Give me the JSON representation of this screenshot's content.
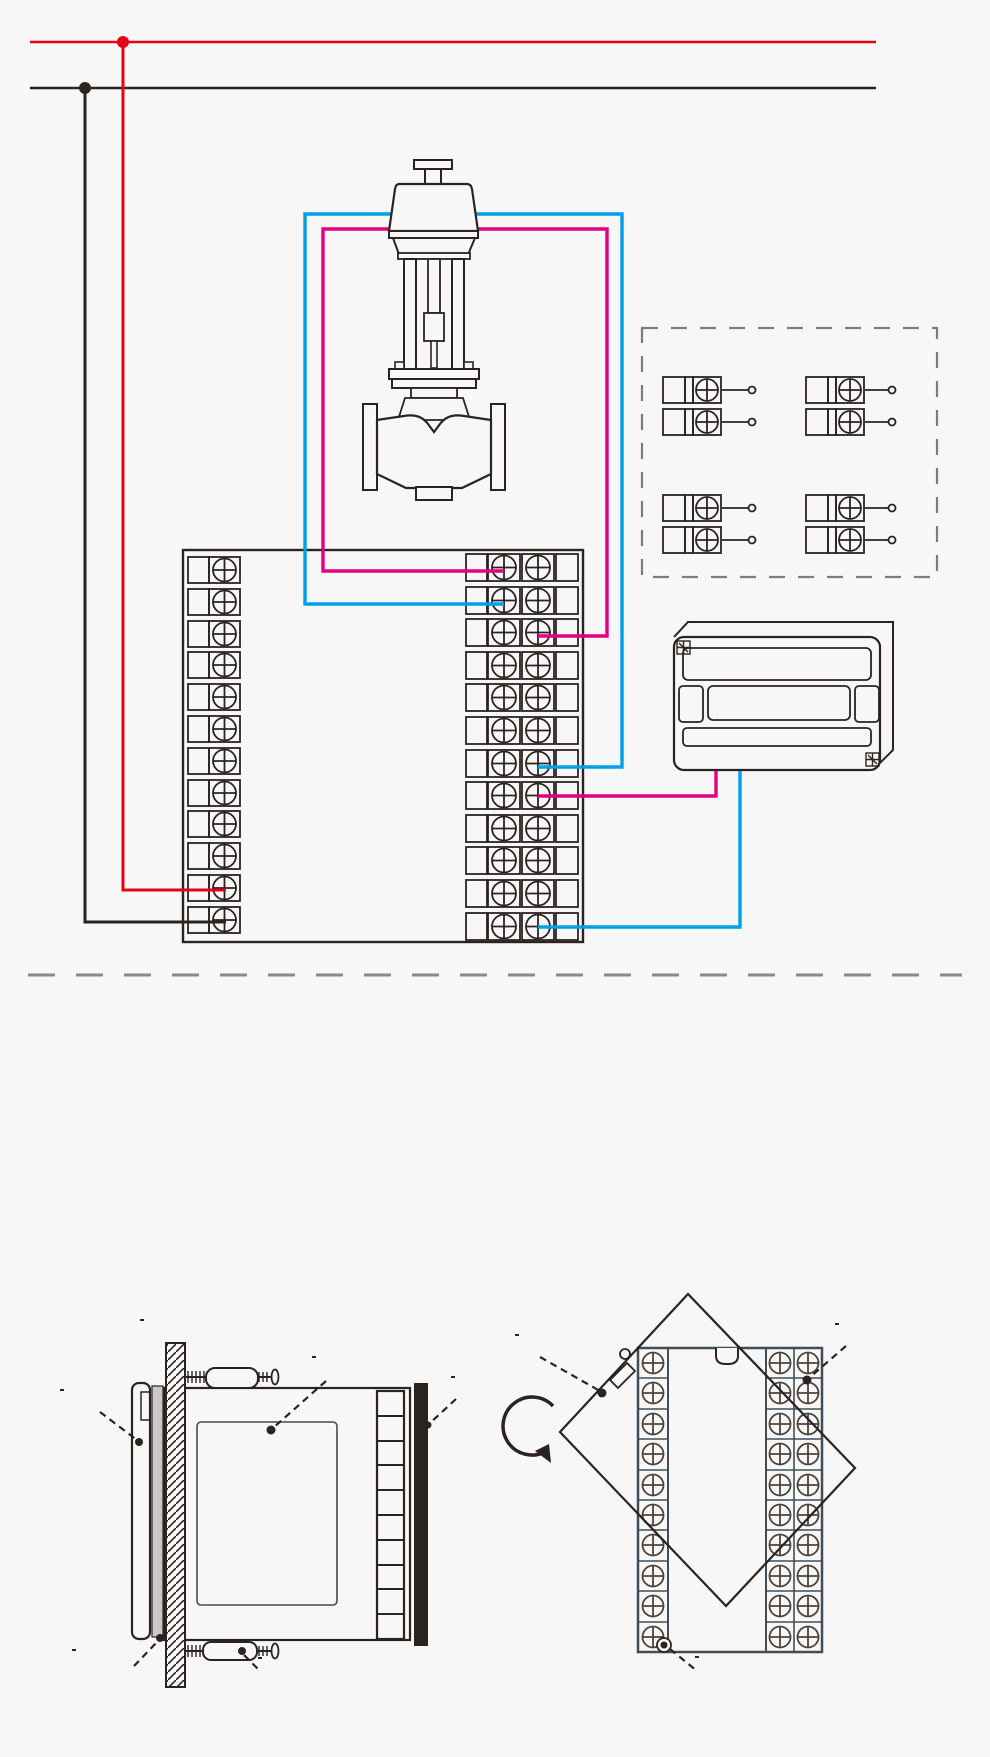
{
  "power": {
    "label": "电源端",
    "line_l": "L",
    "line_n": "N"
  },
  "valve": {
    "label": "调节阀",
    "minus": "−",
    "plus": "+",
    "feedback_range": "4~20mA",
    "feedback_name": "阀位反馈"
  },
  "terminal_info_box": {
    "valve_feedback_input": {
      "title": "阀位反馈输入",
      "t1": "15",
      "t1_sign": "+",
      "t2": "19",
      "t2_sign": "−",
      "unit": "mAin"
    },
    "control_output": {
      "title": "控制输出",
      "t1": "25",
      "t1_sign": "+",
      "t2": "26",
      "t2_sign": "−",
      "unit": "4-20mA"
    },
    "external_setpoint_input": {
      "title": "外给定输入",
      "t1": "20",
      "t1_sign": "+",
      "t2": "24",
      "t2_sign": "−",
      "unit": "mAin"
    },
    "working_power": {
      "title": "工作电源",
      "t1": "11",
      "t1_sign": "L",
      "t2": "12",
      "t2_sign": "N"
    }
  },
  "terminal_block": {
    "left": [
      "1",
      "2",
      "3",
      "4",
      "5",
      "6",
      "7",
      "8",
      "9",
      "10",
      "11",
      "12"
    ],
    "mid": [
      "25",
      "26",
      "27",
      "28",
      "29",
      "30",
      "31",
      "32",
      "33",
      "34",
      "35",
      "36"
    ],
    "right": [
      "13",
      "14",
      "15",
      "16",
      "17",
      "18",
      "19",
      "20",
      "21",
      "22",
      "23",
      "24"
    ],
    "control_plus": "+",
    "control_minus": "−",
    "control_output_label": "控制输出",
    "control_output_range": "4~20mA",
    "ext_plus": "+",
    "ext_minus": "−",
    "ext_setpoint_label": "外给定",
    "ext_setpoint_range": "4~20mA"
  },
  "plc": {
    "label": "PLC"
  },
  "notes": {
    "bullet1": "★ 传感器和通讯线应使用屏蔽绞线.，并在一点接地，布线应远离强电走线；",
    "bullet2": "★ 不同外形尺寸仪表，接线图不尽相同，请以实物为准。",
    "bullet3": "★ 仪表盘式安装：",
    "paragraph": "根据仪表外形尺寸在表盘面上开孔，将仪表嵌入表盘，然后从表盘背面用固定支架将仪表固定在表盘面上，如需安装多台仪表，要求仪表与仪表之间开孔间距≥38mm，以保证必要的散热及装卸空间。如下图所示：",
    "bottom_note": "注：仪表的安装位置应尽量远离马达、变压器等有冲击和震动及电磁干扰的场合。"
  },
  "side_view": {
    "title": "仪表侧面图",
    "panel_board": "仪表盘",
    "front_panel": "面板",
    "sticker": "标签",
    "terminal_cover": "接线盖",
    "gasket": "密封垫",
    "bracket": "固定支架"
  },
  "back_view": {
    "title": "仪表背面图",
    "terminal_cover": "接线盖",
    "terminals": "接线端子",
    "screw_hole": "固定螺丝孔"
  },
  "colors": {
    "live": "#e60012",
    "neutral": "#2b2320",
    "signal_plus": "#e3007f",
    "signal_minus": "#00a0e9"
  }
}
